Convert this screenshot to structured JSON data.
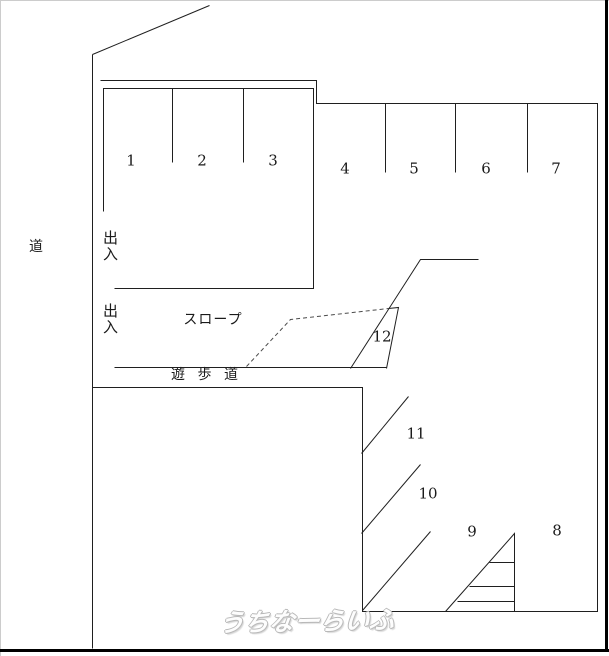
{
  "diagram": {
    "kind": "parking-layout-diagram",
    "labels": {
      "road": "道",
      "entrance_top": "出入",
      "entrance_bottom": "出入",
      "slope": "スロープ",
      "walkway": "遊歩道"
    },
    "spaces": [
      {
        "label": "1"
      },
      {
        "label": "2"
      },
      {
        "label": "3"
      },
      {
        "label": "4"
      },
      {
        "label": "5"
      },
      {
        "label": "6"
      },
      {
        "label": "7"
      },
      {
        "label": "8"
      },
      {
        "label": "9"
      },
      {
        "label": "10"
      },
      {
        "label": "11"
      },
      {
        "label": "12"
      }
    ],
    "watermark": "うちなーらいふ",
    "colors": {
      "line": "#1f1f1f",
      "dashed_line": "#4a4a4a",
      "text": "#1a1a1a",
      "frame_dark": "#000000",
      "frame_light": "#cccccc",
      "watermark_outline": "#b8b8b8",
      "background": "#ffffff"
    }
  }
}
